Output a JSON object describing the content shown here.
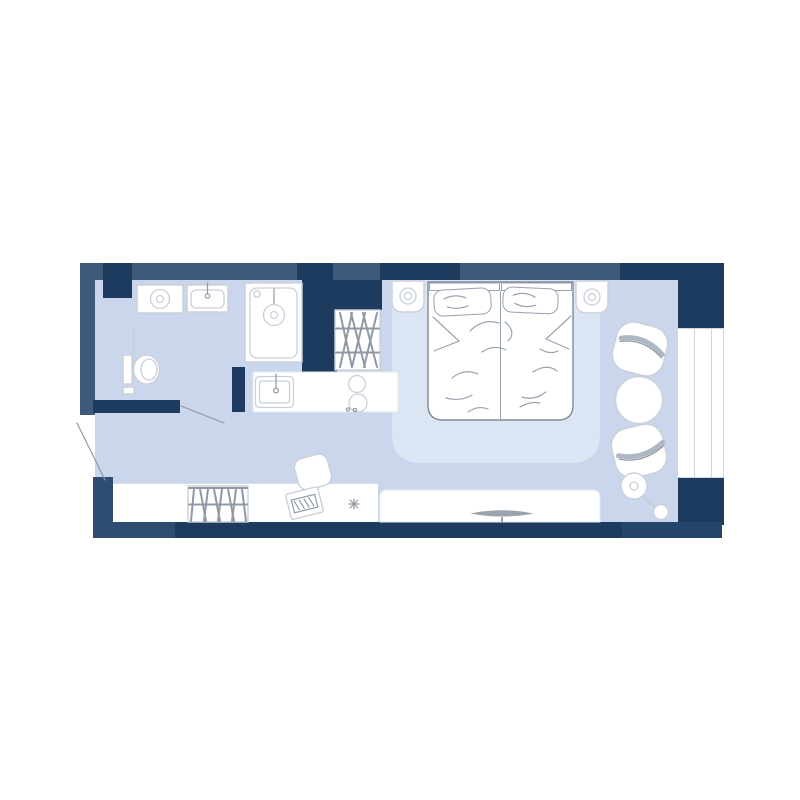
{
  "colors": {
    "background": "#FFFFFF",
    "wall_medium": "#3E5A7A",
    "wall_dark": "#1D3B5E",
    "wall_navy": "#2E4C70",
    "wall_navy_alt": "#24466B",
    "floor": "#C9D6EB",
    "rug": "#DCE5F3",
    "fixture_fill": "#FFFFFF",
    "fixture_stroke": "#C9D0DA",
    "detail_stroke": "#8F99A5",
    "soft_line": "#D7DDE6",
    "tv": "#9AA3AE"
  },
  "floor_plan": {
    "rooms": [
      "bathroom",
      "kitchen",
      "entry-hall",
      "bedroom",
      "lounge"
    ],
    "fixtures": [
      "washing-machine",
      "bathroom-sink",
      "shower",
      "toilet",
      "kitchen-sink",
      "stove-burners",
      "hanging-wardrobe",
      "closet-wardrobe",
      "double-bed",
      "pillows",
      "nightstands",
      "table-lamps",
      "desk",
      "desk-chair",
      "laptop",
      "tv-stand",
      "tv",
      "armchairs",
      "round-table",
      "floor-lamp",
      "window",
      "door-swings"
    ]
  }
}
